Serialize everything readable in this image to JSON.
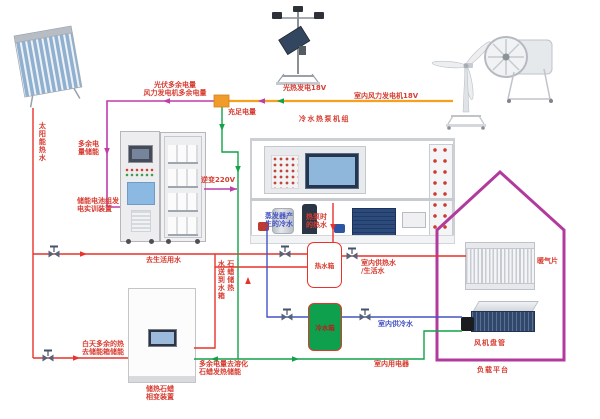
{
  "colors": {
    "hot_water_red": "#E8322B",
    "cold_water_blue": "#4553C4",
    "power_green": "#12A24A",
    "excess_magenta": "#BE3CAC",
    "bus_orange": "#F5A11E",
    "house_outline": "#B13A9C",
    "cold_tank_fill": "#0FA04E",
    "label_red": "#D73C31",
    "label_blue": "#4553C4"
  },
  "icons": {
    "valve-icon": "gate valve (bowtie with stem and handle)",
    "flow-arrow-icon": "small triangle showing flow direction",
    "junction-box-icon": "orange electrical junction block"
  },
  "labels": {
    "solar_hot_water": "太阳能热水",
    "pv_excess_line1": "光伏多余电量",
    "pv_excess_line2": "风力发电机多余电量",
    "pv_gen": "光热发电18V",
    "indoor_wind": "室内风力发电机18V",
    "enough_power": "充足电量",
    "hp_unit": "冷水热泵机组",
    "excess_store_line1": "多余电",
    "excess_store_line2": "量储能",
    "inverter": "逆变220V",
    "battery_line1": "储能电池组发",
    "battery_line2": "电实训装置",
    "evap_line1": "蒸发器产",
    "evap_line2": "生的冷水",
    "hp_hot_line1": "热泵时",
    "hp_hot_line2": "的热水",
    "domestic": "去生活用水",
    "hot_tank": "热水箱",
    "indoor_hot_line1": "室内供热水",
    "indoor_hot_line2": "/生活水",
    "radiator": "暖气片",
    "paraffin_col_left": "水送到水箱",
    "paraffin_col_right": "石蜡储热",
    "day_excess_line1": "白天多余的热",
    "day_excess_line2": "去储能箱储能",
    "cold_tank": "冷水箱",
    "indoor_cold": "室内供冷水",
    "indoor_appliances": "室内用电器",
    "fan_coil": "风机盘管",
    "load_platform": "负载平台",
    "paraffin_dev_line1": "储热石蜡",
    "paraffin_dev_line2": "相变装置",
    "melt_line1": "多余电量去溶化",
    "melt_line2": "石蜡发热储能"
  }
}
